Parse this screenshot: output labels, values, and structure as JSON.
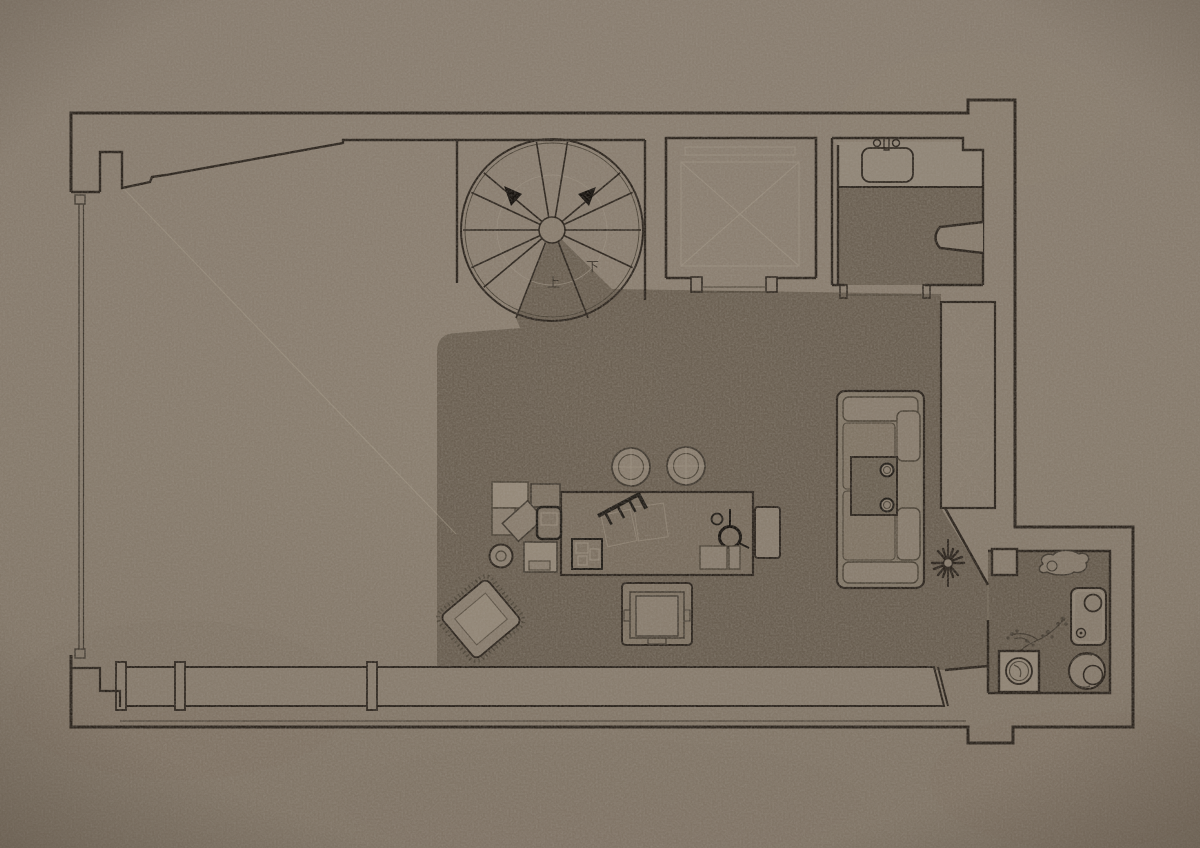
{
  "plan": {
    "type": "apartment-floor-plan",
    "stairs": {
      "up_label": "上",
      "down_label": "下"
    },
    "palette": {
      "paper": "#8c8071",
      "floor_dark": "#6c6153",
      "counter_light": "#958a7b",
      "furniture_light": "#8c8071",
      "ink": "#2b241d",
      "faint_line": "#a79c8b"
    },
    "items": [
      "spiral-staircase",
      "elevator-shaft",
      "bathroom-washbasin",
      "bathroom-urinal",
      "storage-wardrobe",
      "long-table",
      "round-stool",
      "round-stool",
      "table-lamp",
      "book-stand",
      "rattan-armchair",
      "armchair",
      "sofa",
      "side-tray-table",
      "coffee-cups",
      "radial-plant",
      "storage-bench",
      "glass-sliding-door",
      "kitchen-column",
      "pet-sketch",
      "washstand",
      "bonsai-plant",
      "basin-stand",
      "stone-stool"
    ]
  }
}
